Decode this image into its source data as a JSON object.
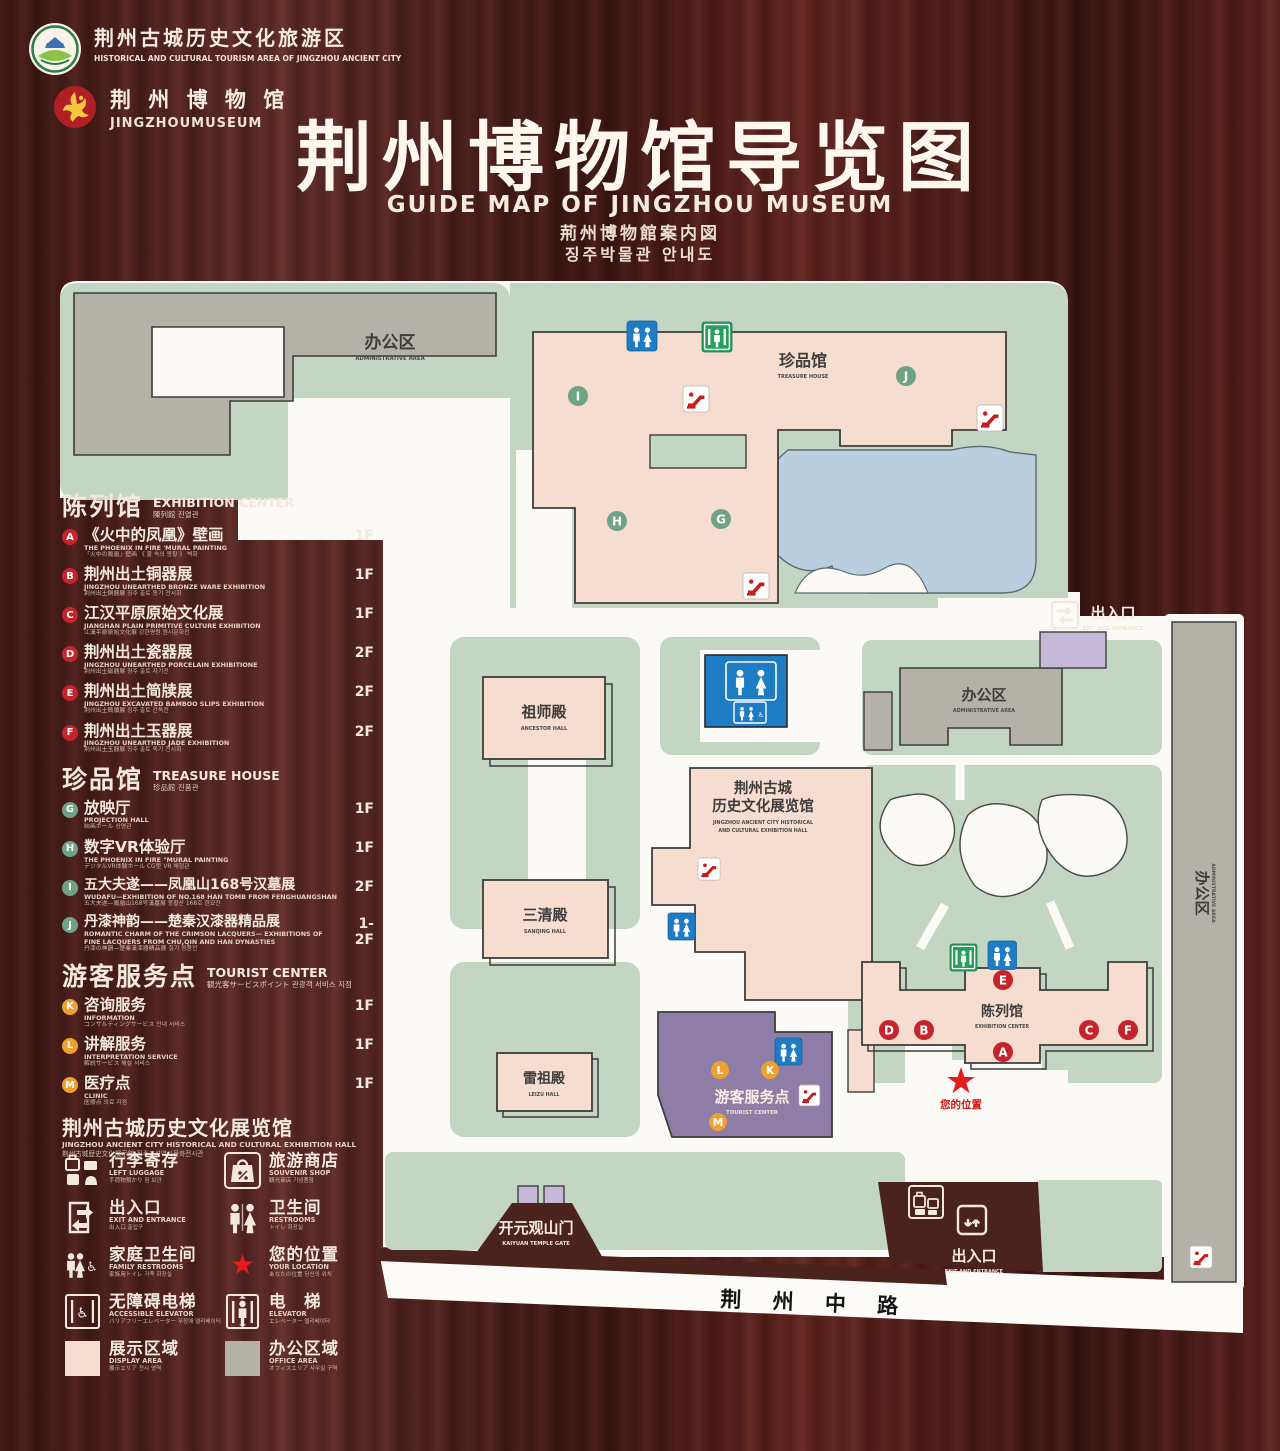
{
  "header": {
    "logo_tourism": {
      "zh": "荆州古城历史文化旅游区",
      "en": "HISTORICAL AND CULTURAL TOURISM AREA OF JINGZHOU ANCIENT CITY"
    },
    "logo_museum": {
      "zh": "荆 州 博 物 馆",
      "en": "JINGZHOUMUSEUM"
    },
    "title_zh": "荆州博物馆导览图",
    "title_en": "GUIDE MAP OF JINGZHOU MUSEUM",
    "title_ja": "荊州博物館案内図",
    "title_ko": "징주박물관 안내도"
  },
  "legend": {
    "exhibition": {
      "title_zh": "陈列馆",
      "title_en": "EXHIBITION CENTER",
      "title_sub": "陳列館  진열관",
      "items": [
        {
          "letter": "A",
          "zh": "《火中的凤凰》壁画",
          "en": "THE PHOENIX IN FIRE 'MURAL PAINTING",
          "sub": "「火中の鳳凰」壁画 《 불 속의 봉황 》 벽화",
          "floor": "1F"
        },
        {
          "letter": "B",
          "zh": "荆州出土铜器展",
          "en": "JINGZHOU UNEARTHED BRONZE WARE EXHIBITION",
          "sub": "荆州出土銅器展  징주 출토 동기 전시회",
          "floor": "1F"
        },
        {
          "letter": "C",
          "zh": "江汉平原原始文化展",
          "en": "JIANGHAN PLAIN PRIMITIVE CULTURE EXHIBITION",
          "sub": "江漢平原原始文化展  강한평원 원시문화전",
          "floor": "1F"
        },
        {
          "letter": "D",
          "zh": "荆州出土瓷器展",
          "en": "JINGZHOU UNEARTHED PORCELAIN EXHIBITIONE",
          "sub": "荆州出土磁器展  징주 출토 자기전",
          "floor": "2F"
        },
        {
          "letter": "E",
          "zh": "荆州出土简牍展",
          "en": "JINGZHOU EXCAVATED BAMBOO SLIPS EXHIBITION",
          "sub": "荆州出土簡牘展  징주 출토 간독전",
          "floor": "2F"
        },
        {
          "letter": "F",
          "zh": "荆州出土玉器展",
          "en": "JINGZHOU UNEARTHED JADE EXHIBITION",
          "sub": "荆州出土玉器展  징주 출토 옥기 전시회",
          "floor": "2F"
        }
      ]
    },
    "treasure": {
      "title_zh": "珍品馆",
      "title_en": "TREASURE HOUSE",
      "title_sub": "珍品館  진품관",
      "items": [
        {
          "letter": "G",
          "zh": "放映厅",
          "en": "PROJECTION HALL",
          "sub": "映画ホール  상영관",
          "floor": "1F"
        },
        {
          "letter": "H",
          "zh": "数字VR体验厅",
          "en": "THE PHOENIX IN FIRE \"MURAL PAINTING",
          "sub": "デジタルVR体験ホール  CG型 VR 체험관",
          "floor": "1F"
        },
        {
          "letter": "I",
          "zh": "五大夫遂——凤凰山168号汉墓展",
          "en": "WUDAFU—EXHIBITION OF NO.168 HAN TOMB FROM FENGHUANGSHAN",
          "sub": "五大夫遂—鳳凰山168号漢墓展  봉황산 168호 한묘전",
          "floor": "2F"
        },
        {
          "letter": "J",
          "zh": "丹漆神韵——楚秦汉漆器精品展",
          "en": "ROMANTIC CHARM OF THE CRIMSON LACQUERS— EXHIBITIONS OF FINE LACQUERS FROM CHU,QIN AND HAN DYNASTIES",
          "sub": "丹漆の神韻—楚秦漢漆器精品展  칠기 정품전",
          "floor": "1-2F"
        }
      ]
    },
    "tourist": {
      "title_zh": "游客服务点",
      "title_en": "TOURIST CENTER",
      "title_sub": "観光客サービスポイント  관광객 서비스 지점",
      "items": [
        {
          "letter": "K",
          "zh": "咨询服务",
          "en": "INFORMATION",
          "sub": "コンサルティングサービス  안내 서비스",
          "floor": "1F"
        },
        {
          "letter": "L",
          "zh": "讲解服务",
          "en": "INTERPRETATION SERVICE",
          "sub": "解説サービス  해설 서비스",
          "floor": "1F"
        },
        {
          "letter": "M",
          "zh": "医疗点",
          "en": "CLINIC",
          "sub": "医療点  의료 지점",
          "floor": "1F"
        }
      ]
    },
    "hall": {
      "zh": "荆州古城历史文化展览馆",
      "en": "JINGZHOU ANCIENT CITY HISTORICAL AND CULTURAL EXHIBITION HALL",
      "sub": "荆州古城歴史文化展示館   징주고성역사문화전시관"
    },
    "icons": [
      {
        "icon": "left-luggage-icon",
        "zh": "行李寄存",
        "en": "LEFT LUGGAGE",
        "sub": "手荷物預かり  짐 보관"
      },
      {
        "icon": "souvenir-shop-icon",
        "zh": "旅游商店",
        "en": "SOUVENIR SHOP",
        "sub": "観光商店  기념품점"
      },
      {
        "icon": "exit-entrance-icon",
        "zh": "出入口",
        "en": "EXIT AND ENTRANCE",
        "sub": "出入口  출입구"
      },
      {
        "icon": "restrooms-icon",
        "zh": "卫生间",
        "en": "RESTROOMS",
        "sub": "トイレ  화장실"
      },
      {
        "icon": "family-restrooms-icon",
        "zh": "家庭卫生间",
        "en": "FAMILY RESTROOMS",
        "sub": "家族用トイレ  가족 화장실"
      },
      {
        "icon": "your-location-icon",
        "zh": "您的位置",
        "en": "YOUR LOCATION",
        "sub": "あなたの位置  당신의 위치"
      },
      {
        "icon": "accessible-elevator-icon",
        "zh": "无障碍电梯",
        "en": "ACCESSIBLE ELEVATOR",
        "sub": "バリアフリーエレベーター  무장애 엘리베이터"
      },
      {
        "icon": "elevator-icon",
        "zh": "电　梯",
        "en": "ELEVATOR",
        "sub": "エレベーター  엘리베이터"
      },
      {
        "icon": "display-area-swatch",
        "zh": "展示区域",
        "en": "DISPLAY AREA",
        "sub": "展示エリア  전시 영역"
      },
      {
        "icon": "office-area-swatch",
        "zh": "办公区域",
        "en": "OFFICE AREA",
        "sub": "オフィスエリア  사무실 구역"
      }
    ]
  },
  "map": {
    "admin_tl": {
      "zh": "办公区",
      "en": "ADMINISTRATIVE AREA"
    },
    "treasure": {
      "zh": "珍品馆",
      "en": "TREASURE HOUSE"
    },
    "exit_top": {
      "zh": "出入口",
      "en": "EXIT AND ENTRANCE"
    },
    "admin_r": {
      "zh": "办公区",
      "en": "ADMINISTRATIVE AREA"
    },
    "admin_strip": {
      "zh": "办公区",
      "en": "ADMINISTRATIVE AREA"
    },
    "ancestor": {
      "zh": "祖师殿",
      "en": "ANCESTOR HALL"
    },
    "sanqing": {
      "zh": "三清殿",
      "en": "SANQING HALL"
    },
    "leizu": {
      "zh": "雷祖殿",
      "en": "LEIZU HALL"
    },
    "hist": {
      "zh1": "荆州古城",
      "zh2": "历史文化展览馆",
      "en1": "JINGZHOU ANCIENT CITY HISTORICAL",
      "en2": "AND CULTURAL EXHIBITION HALL"
    },
    "tourist": {
      "zh": "游客服务点",
      "en": "TOURIST CENTER"
    },
    "exhibition": {
      "zh": "陈列馆",
      "en": "EXHIBITION CENTER"
    },
    "location": "您的位置",
    "gate": {
      "zh": "开元观山门",
      "en": "KAIYUAN TEMPLE GATE"
    },
    "exit_bottom": {
      "zh": "出入口",
      "en": "EXIT AND ENTRANCE"
    },
    "road": "荆 州 中 路",
    "markers": {
      "A": "A",
      "B": "B",
      "C": "C",
      "D": "D",
      "E": "E",
      "F": "F",
      "G": "G",
      "H": "H",
      "I": "I",
      "J": "J",
      "K": "K",
      "L": "L",
      "M": "M"
    }
  },
  "colors": {
    "display_area": "#f6ddd0",
    "office_area": "#b4b2a8",
    "courtyard_green": "#c3d5c3",
    "water": "#b9cfdf",
    "tourist_purple": "#8e7da6",
    "marker_red": "#c5242c",
    "marker_green": "#6fa287",
    "marker_orange": "#eea12f",
    "restroom_blue": "#1d7cc4",
    "elevator_green": "#27a05c",
    "location_red": "#e31c1c"
  }
}
